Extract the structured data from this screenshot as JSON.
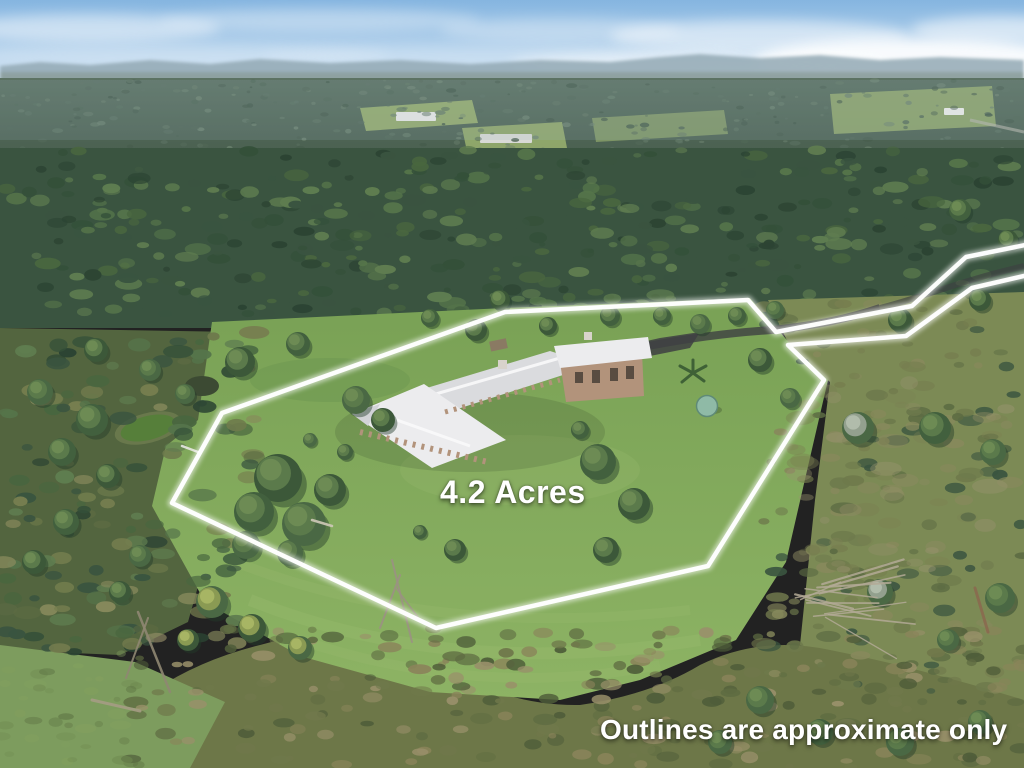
{
  "photo": {
    "kind": "aerial-drone-real-estate-photo",
    "scene": "Rural acreage with large white-roofed homestead, cleared lawns, dam, water tank and surrounding bushland"
  },
  "labels": {
    "area": "4.2 Acres",
    "disclaimer": "Outlines are approximate only"
  },
  "boundary": {
    "points": "505,312 748,300 776,332 912,306 966,257 1045,241 1045,271 972,288 906,336 788,345 824,380 708,566 436,628 172,503 222,413",
    "color": "#ffffff",
    "stroke_width": "4.5",
    "glow_width": "9"
  },
  "palette": {
    "sky_top": "#85b5e0",
    "sky_horizon": "#e6f0f8",
    "cloud": "#ffffff",
    "ridge_haze": "#93a9b4",
    "forest_far_top": "#5c7263",
    "forest_far_bottom": "#465c4c",
    "forest_mid": "#3a5440",
    "forest_dark": "#2c4433",
    "forest_light": "#5f7d50",
    "clearing": "#9fb671",
    "lawn_top": "#79a155",
    "lawn_bottom": "#8db364",
    "lawn_light": "#9cbd70",
    "lawn_shade": "#6a9350",
    "hillside": "#7c8a55",
    "scrub": "#6d7748",
    "bottom_grass": "#7d9c5e",
    "pond": "#567f3a",
    "pond_dark": "#3c4a33",
    "roof": "#ececee",
    "roof_shade": "#dadbde",
    "walls": "#b2937b",
    "window": "#4a4038",
    "driveway": "#3e4042",
    "tank": "#8fbaa6",
    "dead_wood": "#b3aa96",
    "text": "#ffffff"
  }
}
